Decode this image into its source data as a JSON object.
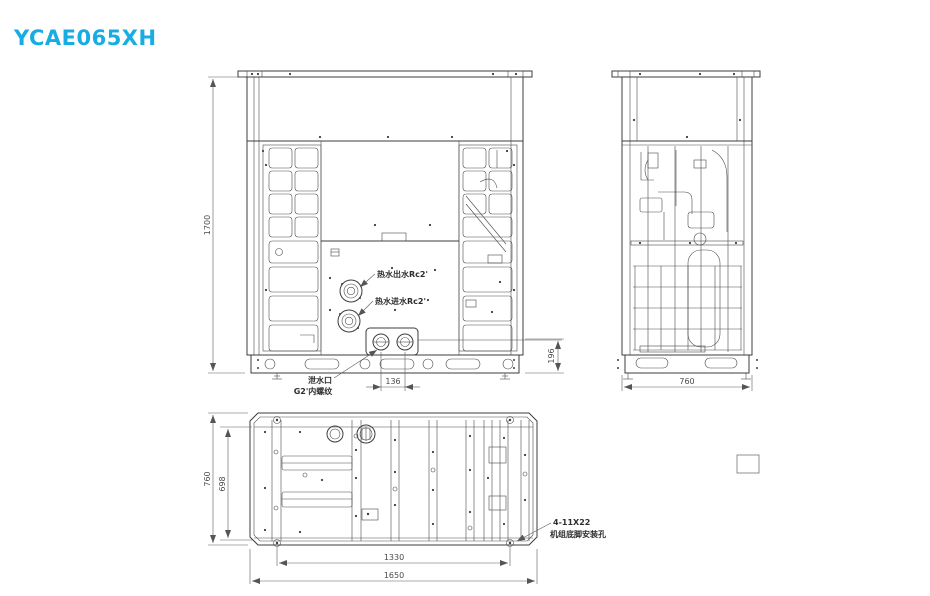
{
  "title": "YCAE065XH",
  "colors": {
    "accent": "#17ade2",
    "line": "#3d3d3d"
  },
  "front_view": {
    "dim_height": "1700",
    "dim_base_height": "196",
    "dim_drain_spacing": "136",
    "label_hot_water_outlet": "热水出水Rc2'",
    "label_hot_water_inlet": "热水进水Rc2'",
    "label_drain_port_line1": "泄水口",
    "label_drain_port_line2": "G2'内螺纹"
  },
  "side_view": {
    "dim_width": "760"
  },
  "plan_view": {
    "dim_depth": "760",
    "dim_inner_depth": "698",
    "dim_hole_span": "1330",
    "dim_length": "1650",
    "label_mounting_holes_line1": "4-11X22",
    "label_mounting_holes_line2": "机组底脚安装孔"
  }
}
